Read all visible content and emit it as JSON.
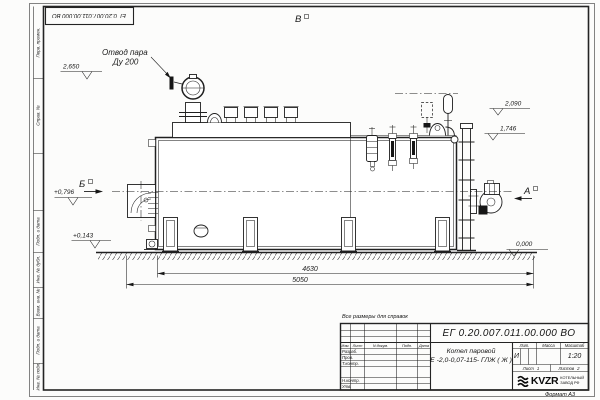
{
  "sheet": {
    "doc_number_stamp": "ЕГ 0.20.007.011.00.000  ВО",
    "format_label": "Формат А3",
    "reference_note": "Все размеры для справок",
    "margin_labels": [
      "Перв. примен.",
      "Справ. №",
      "Подп. и дата",
      "Инв. № дубл.",
      "Взам. инв. №",
      "Подп. и дата",
      "Инв. № подл."
    ]
  },
  "drawing": {
    "callout_line1": "Отвод пара",
    "callout_line2": "Ду 200",
    "view_top": "В",
    "view_left": "Б",
    "view_right": "А",
    "elevations": {
      "e2650": "2,650",
      "e0796": "+0,796",
      "e0143": "+0,143",
      "e2090": "2,090",
      "e1746": "1,746",
      "e0000": "0,000"
    },
    "dimensions": {
      "d4630": "4630",
      "d5050": "5050"
    }
  },
  "title_block": {
    "doc_number": "ЕГ 0.20.007.011.00.000  ВО",
    "product_line1": "Котел паровой",
    "product_line2": "Е -2,0-0,07-115- ГЛЖ ( Ж )",
    "lit_header": "Лит.",
    "mass_header": "Масса",
    "scale_header": "Масштаб",
    "lit_value": "И",
    "scale_value": "1:20",
    "sheet_label": "Лист",
    "sheet_value": "1",
    "sheets_label": "Листов",
    "sheets_value": "2",
    "col_izm": "Изм.",
    "col_list": "Лист",
    "col_doc": "N докум.",
    "col_podp": "Подп.",
    "col_data": "Дата",
    "rows": [
      "Разраб.",
      "Пров.",
      "Т.контр.",
      "Н.контр.",
      "Утв."
    ],
    "logo_text": "KVZR",
    "logo_caption1": "КОТЕЛЬНЫЙ",
    "logo_caption2": "ЗАВОД РФ"
  }
}
